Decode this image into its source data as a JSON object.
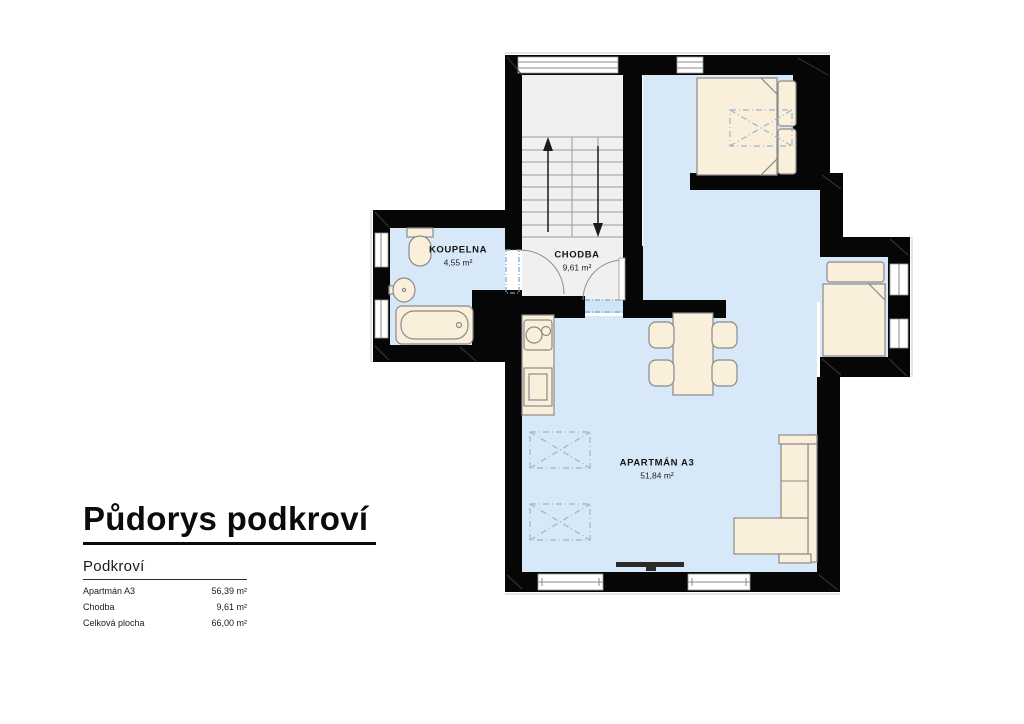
{
  "title": {
    "text": "Půdorys podkroví"
  },
  "legend": {
    "heading": "Podkroví",
    "rows": [
      {
        "label": "Apartmán A3",
        "value": "56,39 m²"
      },
      {
        "label": "Chodba",
        "value": "9,61 m²"
      },
      {
        "label": "Celková plocha",
        "value": "66,00 m²"
      }
    ]
  },
  "rooms": [
    {
      "name": "KOUPELNA",
      "area": "4,55 m²"
    },
    {
      "name": "CHODBA",
      "area": "9,61 m²"
    },
    {
      "name": "APARTMÁN A3",
      "area": "51,84 m²"
    }
  ],
  "colors": {
    "wall": "#060606",
    "apartment_floor": "#D7E9F8",
    "hall_floor": "#F2F0EF",
    "furniture": "#FAEFDB",
    "threshold": "#6FA7D2"
  }
}
